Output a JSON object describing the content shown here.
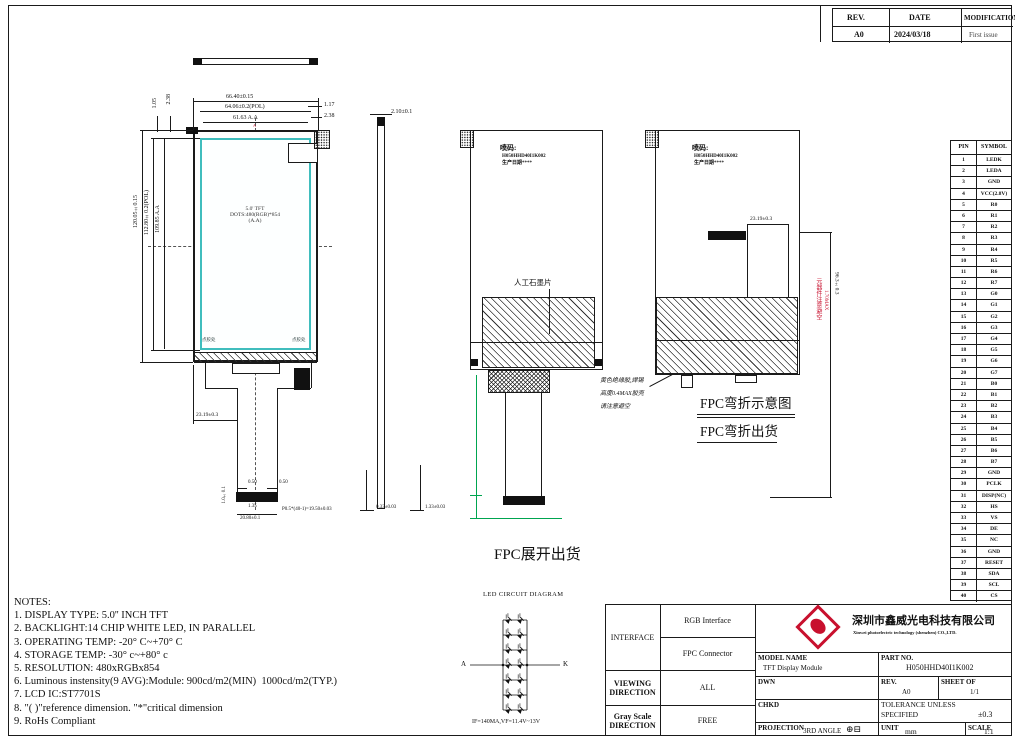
{
  "revision": {
    "h_rev": "REV.",
    "h_date": "DATE",
    "h_mod": "MODIFICATION",
    "rev": "A0",
    "date": "2024/03/18",
    "mod": "First issue"
  },
  "pin_table": {
    "h_pin": "PIN",
    "h_symbol": "SYMBOL",
    "pins": [
      "LEDK",
      "LEDA",
      "GND",
      "VCC(2.8V)",
      "R0",
      "R1",
      "R2",
      "R3",
      "R4",
      "R5",
      "R6",
      "R7",
      "G0",
      "G1",
      "G2",
      "G3",
      "G4",
      "G5",
      "G6",
      "G7",
      "B0",
      "B1",
      "B2",
      "B3",
      "B4",
      "B5",
      "B6",
      "B7",
      "GND",
      "PCLK",
      "DISP(NC)",
      "HS",
      "VS",
      "DE",
      "NC",
      "GND",
      "RESET",
      "SDA",
      "SCL",
      "CS"
    ]
  },
  "notes": {
    "title": "NOTES:",
    "items": [
      "1. DISPLAY TYPE: 5.0'' INCH TFT",
      "2. BACKLIGHT:14 CHIP WHITE LED, IN PARALLEL",
      "3. OPERATING TEMP: -20° C~+70° C",
      "4. STORAGE TEMP: -30° c~+80° c",
      "5. RESOLUTION: 480xRGBx854",
      "6. Luminous instensity(9 AVG):Module: 900cd/m2(MIN)  1000cd/m2(TYP.)",
      "7. LCD IC:ST7701S",
      "8. \"( )\"reference dimension. \"*\"critical dimension",
      "9. RoHs Compliant"
    ]
  },
  "front_view": {
    "dim_w1": "66.40±0.15",
    "dim_w2": "64.06±0.2(POL)",
    "dim_w3": "61.63 A.A",
    "dim_r1": "1.17",
    "dim_r2": "2.38",
    "dim_l1": "1.05",
    "dim_l2": "2.38",
    "dim_h1": "120.05±0.15",
    "dim_h2": "112.80±0.2(POL)",
    "dim_h3": "109.85 A.A",
    "center1": "5.0' TFT",
    "center2": "DOTS:480(RGB)*854",
    "center3": "(A.A)",
    "marker_a": "A",
    "glue_l": "点胶处",
    "glue_r": "点胶处",
    "dim_offset": "23.19±0.3",
    "dim_c1": "0.50",
    "dim_c2": "0.50",
    "dim_c3": "1.35",
    "dim_c4": "20.80±0.1",
    "dim_pitch": "P0.5*(40-1)=19.50±0.03",
    "dim_c5": "1.0±0.1"
  },
  "side_view": {
    "dim_t": "2.10±0.1",
    "dim_b1": "0.33±0.03",
    "dim_b2": "1.33±0.03"
  },
  "back_view": {
    "spray1": "喷码:",
    "spray2": "H050HHD40I1K002",
    "spray3": "生产日期****",
    "graphite": "人工石墨片"
  },
  "bend_view": {
    "spray1": "喷码:",
    "spray2": "H050HHD40I1K002",
    "spray3": "生产日期****",
    "dim_top": "23.19±0.3",
    "dim_right": "96.3±0.3",
    "red1": "元器件注意避空",
    "red2": "1.70MAX",
    "glue1": "黄色绝缘胶,焊锡",
    "glue2": "高度0.4MAX胶壳",
    "glue3": "请注意避空",
    "t1": "FPC弯折示意图",
    "t2": "FPC弯折出货"
  },
  "labels": {
    "flat_ship": "FPC展开出货"
  },
  "led": {
    "title": "LED CIRCUIT DIAGRAM",
    "a": "A",
    "k": "K",
    "spec": "IF=140MA,VF=11.4V~13V"
  },
  "title_block": {
    "interface_label": "INTERFACE",
    "interface_1": "RGB Interface",
    "interface_2": "FPC Connector",
    "viewing_1": "VIEWING",
    "viewing_2": "DIRECTION",
    "viewing_val": "ALL",
    "gray_1": "Gray Scale",
    "gray_2": "DIRECTION",
    "gray_val": "FREE",
    "model_label": "MODEL NAME",
    "model_val": "TFT Display Module",
    "part_label": "PART NO.",
    "part_val": "H050HHD40I1K002",
    "dwn": "DWN",
    "chkd": "CHKD",
    "rev_label": "REV.",
    "rev_val": "A0",
    "sheet_label": "SHEET OF",
    "sheet_val": "1/1",
    "tol_1": "TOLERANCE UNLESS",
    "tol_2": "SPECIFIED",
    "tol_val": "±0.3",
    "proj_label": "PROJECTION",
    "proj_val": "3RD ANGLE",
    "proj_sym": "⊕⊟",
    "unit_label": "UNIT",
    "unit_val": "mm",
    "scale_label": "SCALE",
    "scale_val": "1:1",
    "company_cn": "深圳市鑫威光电科技有限公司",
    "company_en": "Xinwei photoelectric technology (shenzhen) CO.,LTD."
  }
}
